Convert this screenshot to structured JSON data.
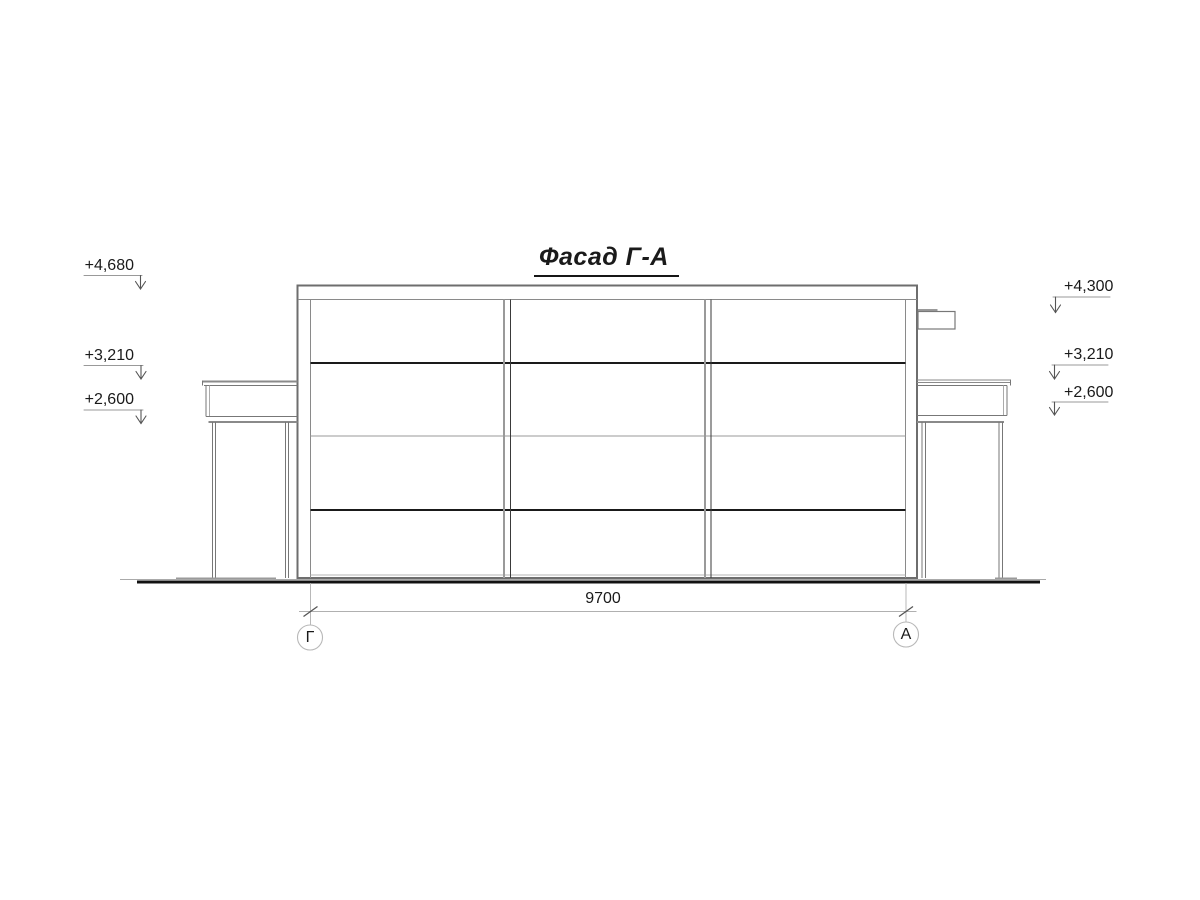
{
  "title": {
    "text": "Фасад Г-А"
  },
  "elevation_marks": {
    "left": [
      {
        "label": "+4,680"
      },
      {
        "label": "+3,210"
      },
      {
        "label": "+2,600"
      }
    ],
    "right": [
      {
        "label": "+4,300"
      },
      {
        "label": "+3,210"
      },
      {
        "label": "+2,600"
      }
    ]
  },
  "dimension": {
    "value": "9700"
  },
  "axes": {
    "left": {
      "label": "Г"
    },
    "right": {
      "label": "А"
    }
  },
  "colors": {
    "line_dark": "#1a1a1a",
    "line_medium": "#6e6e6e",
    "line_light": "#9a9a9a",
    "background": "#ffffff"
  }
}
